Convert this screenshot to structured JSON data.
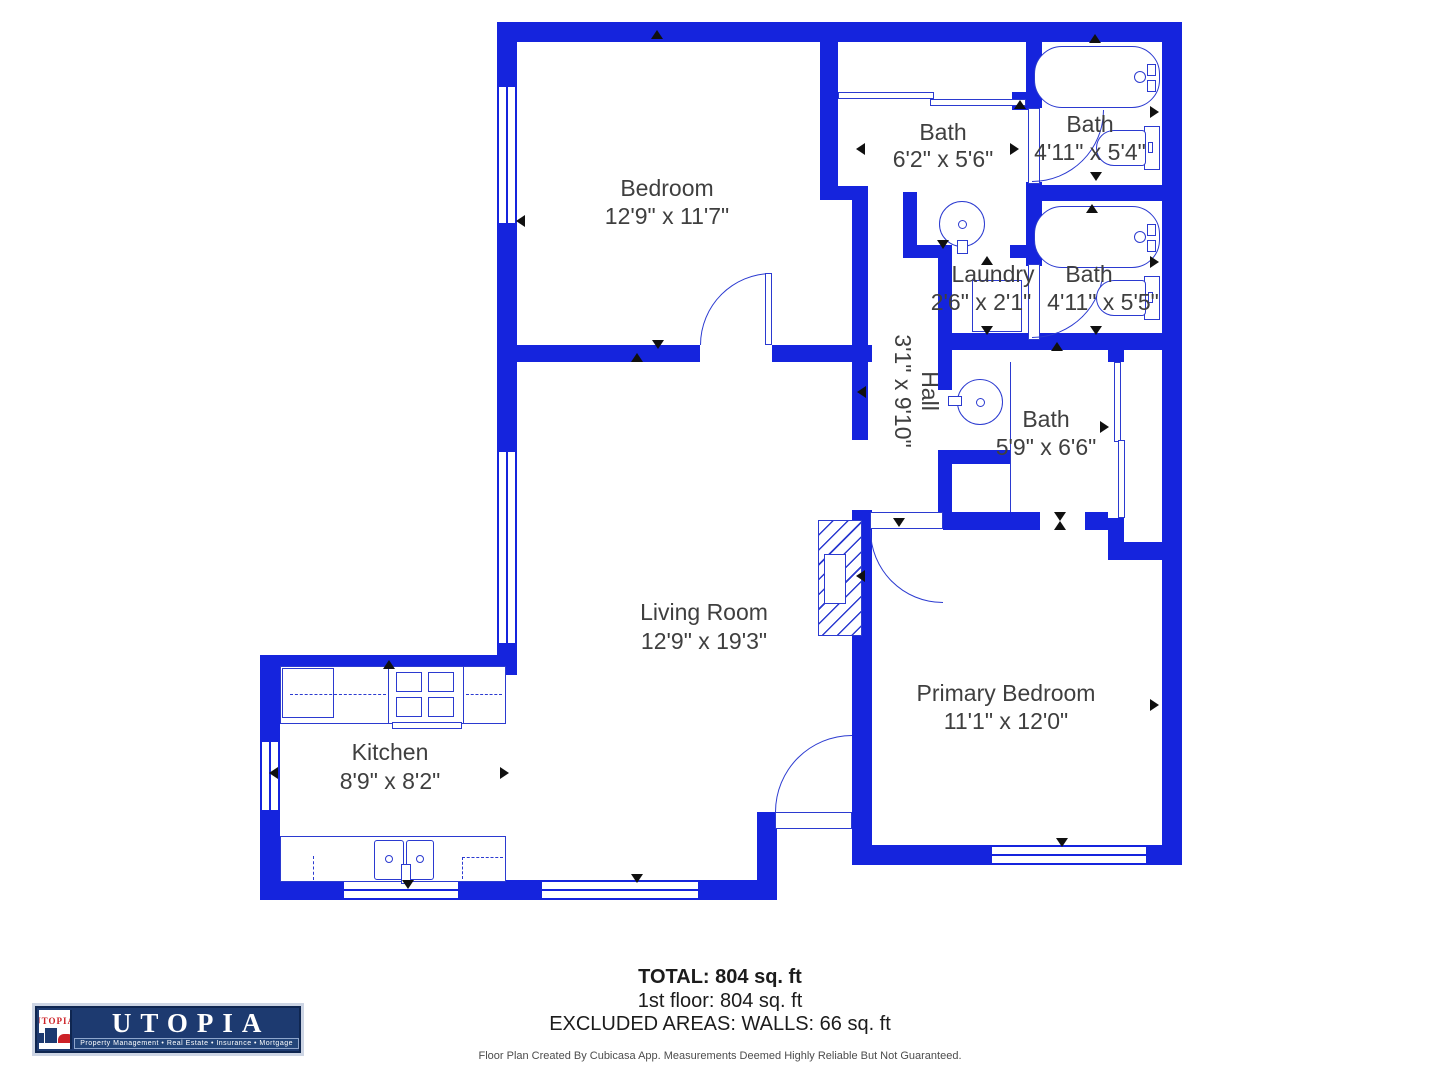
{
  "rooms": [
    {
      "name": "Bedroom",
      "dims": "12'9\" x 11'7\""
    },
    {
      "name": "Bath",
      "dims": "6'2\" x 5'6\""
    },
    {
      "name": "Bath",
      "dims": "4'11\" x 5'4\""
    },
    {
      "name": "Laundry",
      "dims": "2'6\" x 2'1\""
    },
    {
      "name": "Bath",
      "dims": "4'11\" x 5'5\""
    },
    {
      "name": "Hall",
      "dims": "3'1\" x 9'10\""
    },
    {
      "name": "Bath",
      "dims": "5'9\" x 6'6\""
    },
    {
      "name": "Living Room",
      "dims": "12'9\" x 19'3\""
    },
    {
      "name": "Kitchen",
      "dims": "8'9\" x 8'2\""
    },
    {
      "name": "Primary Bedroom",
      "dims": "11'1\" x 12'0\""
    }
  ],
  "summary": {
    "total": "TOTAL: 804 sq. ft",
    "floor1": "1st floor: 804 sq. ft",
    "excluded": "EXCLUDED AREAS: WALLS: 66 sq. ft"
  },
  "disclaimer": "Floor Plan Created By Cubicasa App. Measurements Deemed Highly Reliable But Not Guaranteed.",
  "logo": {
    "brand": "UTOPIA",
    "brand_small": "UTOPIA",
    "tagline": "Property Management • Real Estate • Insurance • Mortgage"
  },
  "colors": {
    "wall_blue": "#1524dd",
    "fixture_blue": "#2b3ad0",
    "label_text": "#3f3f3f",
    "logo_navy": "#1d3a70",
    "logo_red": "#cc2127"
  }
}
